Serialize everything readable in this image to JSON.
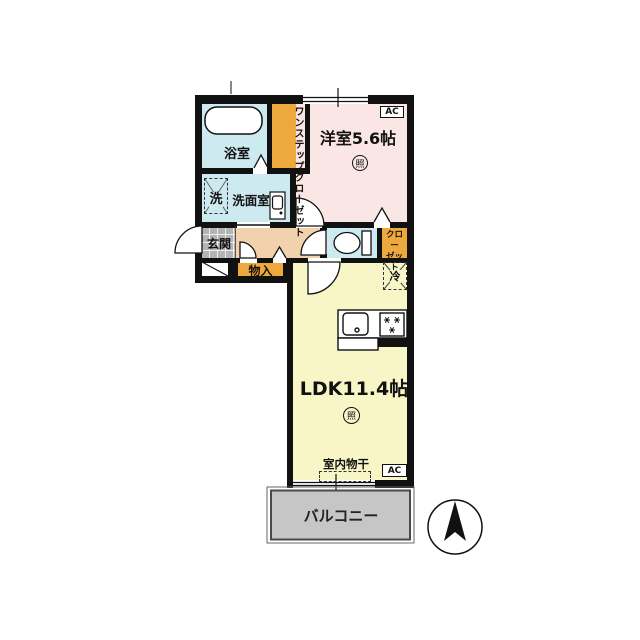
{
  "labels": {
    "bathroom": "浴室",
    "one_step_closet_col1": "ワンステップ",
    "one_step_closet_col2": "クローゼット",
    "washer": "洗",
    "washroom": "洗面室",
    "entrance": "玄関",
    "storage": "物入",
    "western_room": "洋室5.6帖",
    "light": "照",
    "ac": "AC",
    "closet_line1": "クロー",
    "closet_line2": "ゼット",
    "fridge": "冷",
    "ldk": "LDK11.4帖",
    "indoor_drying": "室内物干",
    "balcony": "バルコニー"
  },
  "icons": {
    "north_arrow": "compass-north-arrow",
    "toilet": "toilet-icon",
    "bathtub": "bathtub-icon",
    "kitchen_sink": "kitchen-sink-icon",
    "stove": "stove-burners-icon",
    "washbasin": "washbasin-icon"
  },
  "colors": {
    "wall": "#111111",
    "western_room_pink": "#fae6e4",
    "ldk_yellow": "#f8f6c6",
    "water_area_blue": "#cdeaf0",
    "hallway_beige": "#f2d2ac",
    "closet_orange": "#eea93e",
    "entrance_gray": "#b4b4b4",
    "balcony_gray": "#c6c6c6"
  }
}
